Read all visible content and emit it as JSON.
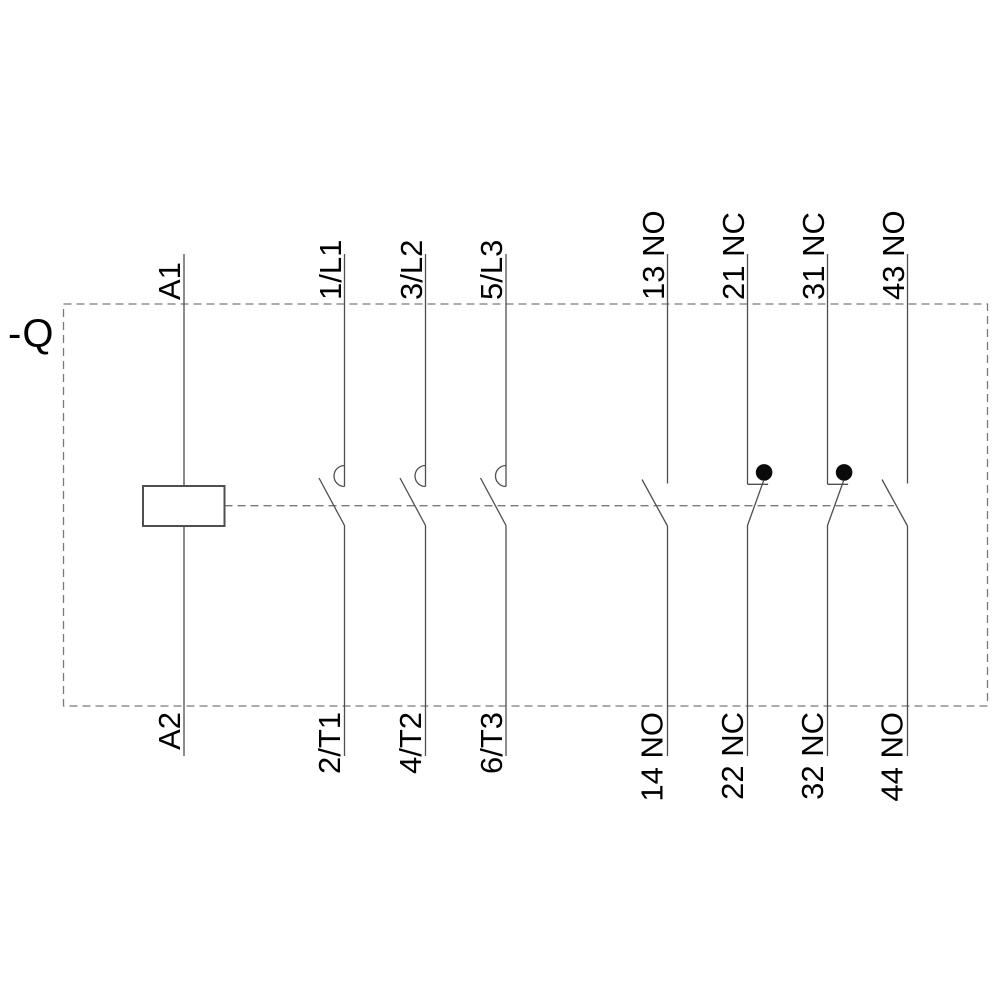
{
  "device": {
    "designation": "-Q",
    "kind": "contactor schematic"
  },
  "terminals": {
    "top": [
      "A1",
      "1/L1",
      "3/L2",
      "5/L3",
      "13 NO",
      "21 NC",
      "31 NC",
      "43 NO"
    ],
    "bottom": [
      "A2",
      "2/T1",
      "4/T2",
      "6/T3",
      "14 NO",
      "22 NC",
      "32 NC",
      "44 NO"
    ]
  },
  "poles": [
    {
      "type": "coil",
      "top": "A1",
      "bottom": "A2"
    },
    {
      "type": "main-no-contact",
      "top": "1/L1",
      "bottom": "2/T1"
    },
    {
      "type": "main-no-contact",
      "top": "3/L2",
      "bottom": "4/T2"
    },
    {
      "type": "main-no-contact",
      "top": "5/L3",
      "bottom": "6/T3"
    },
    {
      "type": "aux-no-contact",
      "top": "13 NO",
      "bottom": "14 NO"
    },
    {
      "type": "aux-nc-contact",
      "top": "21 NC",
      "bottom": "22 NC"
    },
    {
      "type": "aux-nc-contact",
      "top": "31 NC",
      "bottom": "32 NC"
    },
    {
      "type": "aux-no-contact",
      "top": "43 NO",
      "bottom": "44 NO"
    }
  ],
  "colors": {
    "background": "#ffffff",
    "solid_line": "#4f4f4f",
    "dashed_line": "#7a7a7a",
    "text": "#000000",
    "nc_dot": "#0a0a0a"
  }
}
